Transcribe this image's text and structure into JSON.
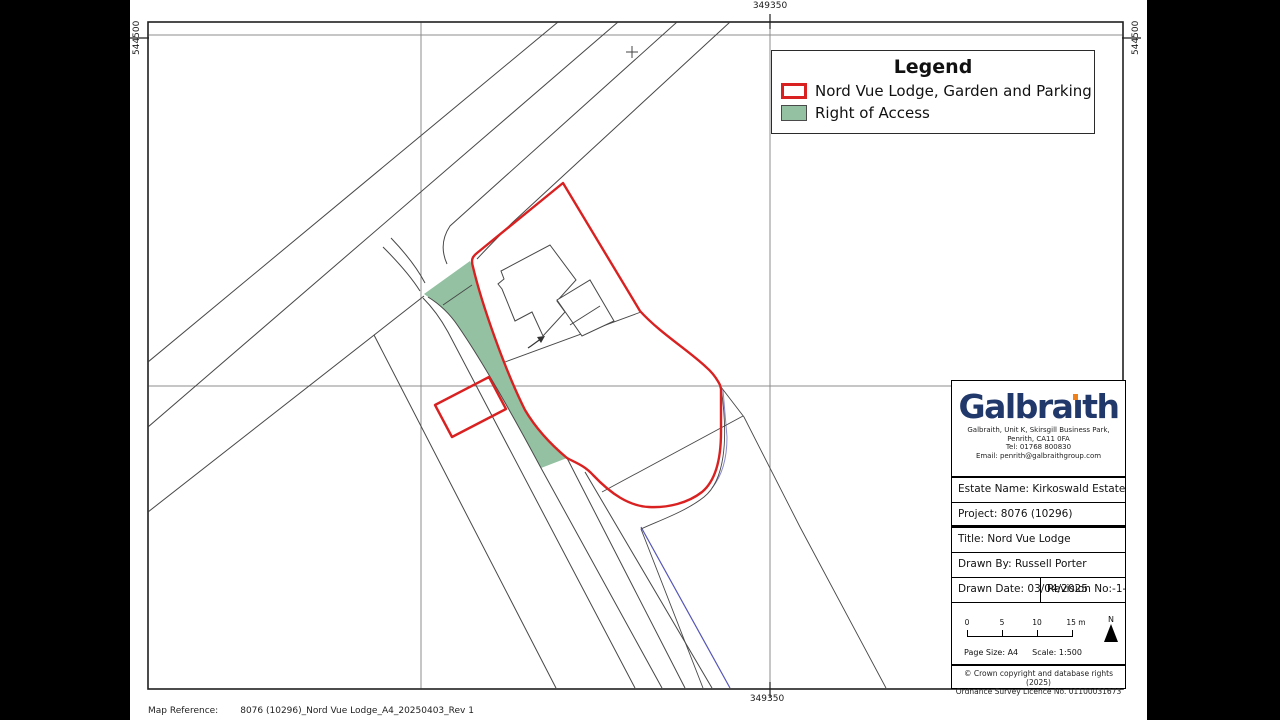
{
  "grid": {
    "easting_top": "349350",
    "easting_bottom": "349350",
    "northing_left": "544500",
    "northing_right": "544500"
  },
  "legend": {
    "title": "Legend",
    "items": [
      {
        "label": "Nord Vue Lodge, Garden and Parking",
        "swatch": "red-outline"
      },
      {
        "label": "Right of Access",
        "swatch": "green-fill"
      }
    ]
  },
  "title_block": {
    "logo": {
      "pre": "Galbra",
      "i_dotless": "ı",
      "post": "th"
    },
    "address_lines": [
      "Galbraith, Unit K, Skirsgill Business Park,",
      "Penrith, CA11 0FA",
      "Tel: 01768 800830",
      "Email: penrith@galbraithgroup.com"
    ],
    "rows": [
      {
        "text": "Estate Name:  Kirkoswald Estate"
      },
      {
        "text": "Project:  8076 (10296)"
      },
      {
        "text": "Title:  Nord Vue Lodge"
      },
      {
        "text": "Drawn By:  Russell Porter"
      }
    ],
    "drawn_date": "Drawn Date: 03/04/2025",
    "revision_label": "Revision No:",
    "revision_value": "-1-",
    "scale_bar": {
      "ticks": [
        "0",
        "5",
        "10",
        "15 m"
      ]
    },
    "north_label": "N",
    "page_size": "Page Size: A4",
    "scale": "Scale:  1:500",
    "copyright_lines": [
      "© Crown copyright and database rights (2025)",
      "Ordnance Survey Licence No. 01100031673"
    ]
  },
  "footer": {
    "map_reference_label": "Map Reference:",
    "map_reference_value": "8076 (10296)_Nord Vue Lodge_A4_20250403_Rev 1"
  },
  "colors": {
    "red": "#d92121",
    "green": "#93c1a1",
    "navy": "#21386b",
    "orange": "#f08019",
    "blue": "#5454b8",
    "line": "#474747",
    "grid": "#8c8c8c",
    "frame": "#1f1f1f"
  }
}
